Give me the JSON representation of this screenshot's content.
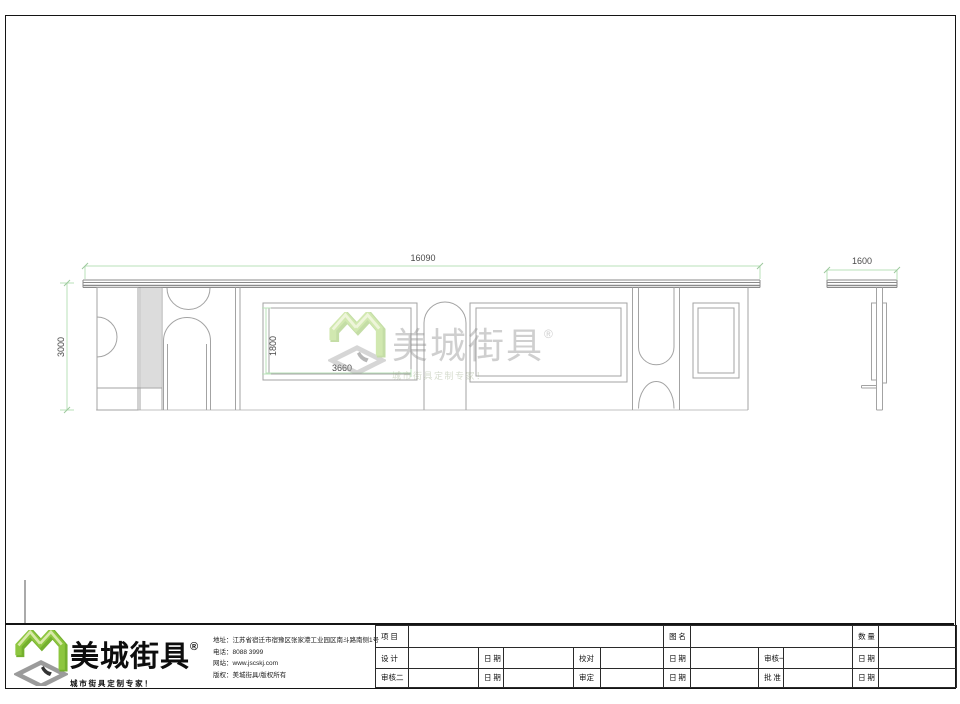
{
  "page": {
    "background": "#ffffff",
    "line_gray": "#a3a3a3",
    "dim_green": "#b9e0b9",
    "brand_green": "#8dc63f"
  },
  "drawing": {
    "dims": {
      "total_width": "16090",
      "overall_height": "3000",
      "panel_width": "3660",
      "panel_height": "1800",
      "side_width": "1600"
    },
    "watermark": {
      "brand": "美城街具",
      "registered": "®",
      "tagline": "城市街具定制专家！"
    }
  },
  "titleblock": {
    "logo": {
      "brand": "美城街具",
      "registered": "®",
      "tagline": "城市街具定制专家！"
    },
    "company_info": {
      "address": "地址：江苏省宿迁市宿豫区张家港工业园区南斗路南侧1号",
      "phone": "电话：8088 3999",
      "website": "网站：www.jscskj.com",
      "copyright": "版权：美城街具/版权所有"
    },
    "table": {
      "row1": [
        "项 目",
        "图 名",
        "数 量"
      ],
      "row2": [
        "设 计",
        "日 期",
        "校对",
        "日 期",
        "审核一",
        "日 期"
      ],
      "row3": [
        "审核二",
        "日 期",
        "审定",
        "日 期",
        "批 准",
        "日 期"
      ]
    }
  }
}
